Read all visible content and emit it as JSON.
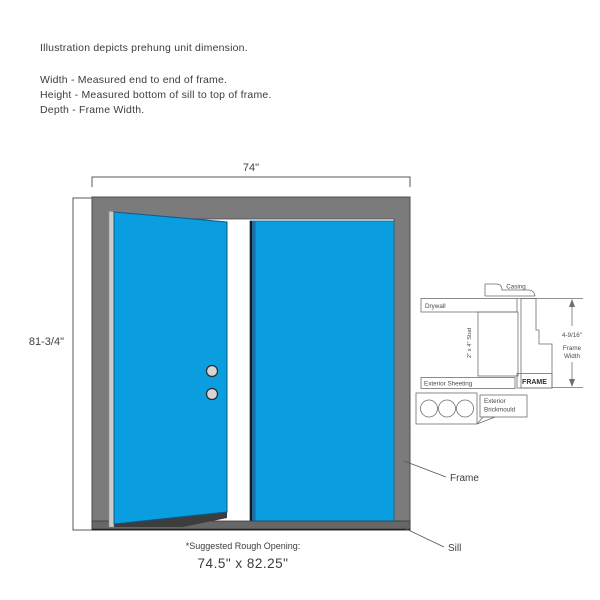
{
  "intro": {
    "line1": "Illustration depicts prehung unit dimension.",
    "line2": "Width - Measured end to end of frame.",
    "line3": "Height - Measured bottom of sill to top of frame.",
    "line4": "Depth - Frame Width."
  },
  "elevation": {
    "width_label": "74\"",
    "height_label": "81-3/4\"",
    "frame_callout": "Frame",
    "sill_callout": "Sill"
  },
  "detail": {
    "casing_label": "Casing",
    "drywall_label": "Drywall",
    "stud_label": "2\" x 4\" Stud",
    "sheeting_label": "Exterior Sheeting",
    "frame_label": "FRAME",
    "dim_label": "4-9/16\"",
    "dim_sub1": "Frame",
    "dim_sub2": "Width",
    "brickmould_line1": "Exterior",
    "brickmould_line2": "Brickmould"
  },
  "footer": {
    "label": "*Suggested Rough Opening:",
    "value": "74.5\" x 82.25\""
  },
  "colors": {
    "door_blue": "#0a9de0",
    "door_edge_blue": "#1a6fa6",
    "frame_gray": "#7b7b7b",
    "sill_gray": "#676767",
    "hinge_strip_gray": "#cccccc",
    "detail_line": "#6e6e6e",
    "text": "#3f3f3f"
  }
}
